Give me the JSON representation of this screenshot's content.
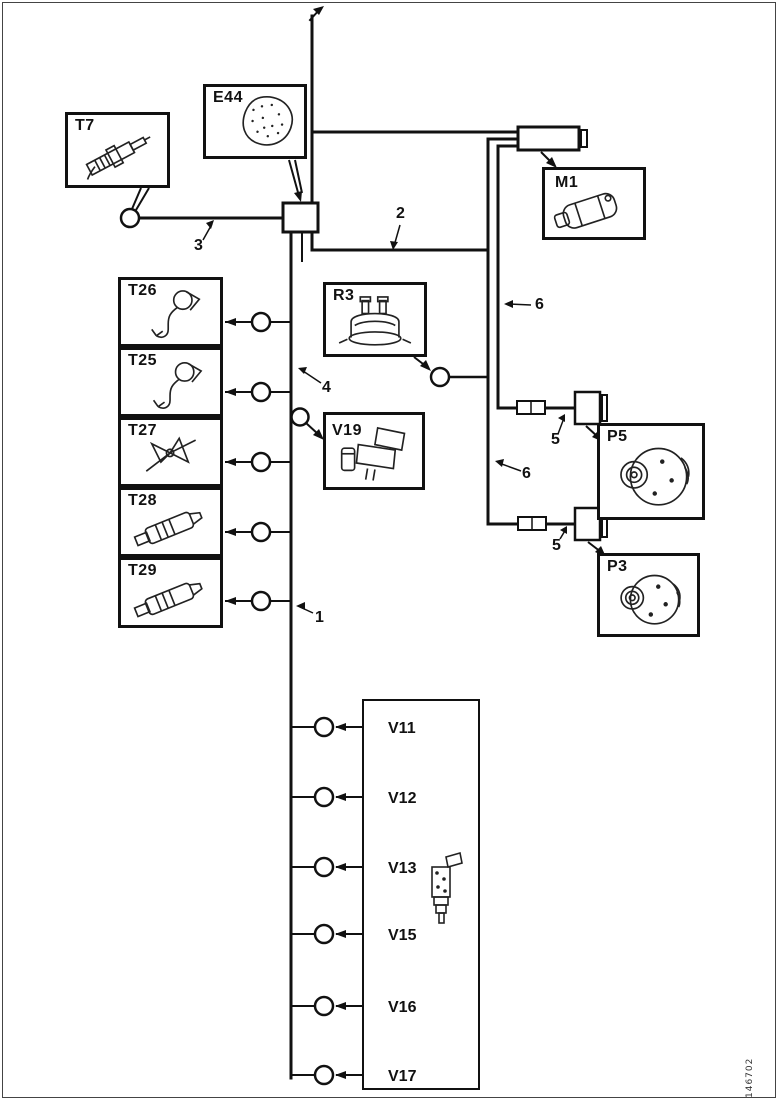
{
  "figure_number": "146702",
  "boxes": {
    "t7": "T7",
    "e44": "E44",
    "m1": "M1",
    "t26": "T26",
    "t25": "T25",
    "t27": "T27",
    "t28": "T28",
    "t29": "T29",
    "r3": "R3",
    "v19": "V19",
    "p5": "P5",
    "p3": "P3"
  },
  "injectors": {
    "items": [
      "V11",
      "V12",
      "V13",
      "V15",
      "V16",
      "V17"
    ]
  },
  "wire_numbers": {
    "main_harness": "1",
    "right_harness": "2",
    "t7_branch": "3",
    "v19_branch": "4",
    "p5_connector": "5",
    "p3_connector": "5",
    "upper_right_leg": "6",
    "lower_right_leg": "6"
  }
}
